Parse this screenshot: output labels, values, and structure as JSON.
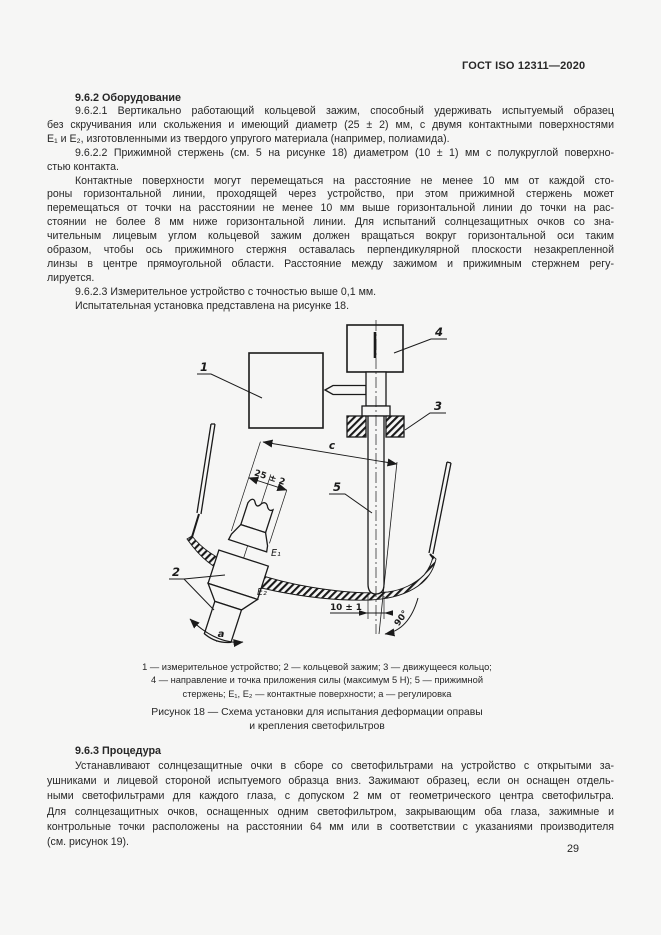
{
  "doc": {
    "header": "ГОСТ ISO 12311—2020",
    "page_number": "29",
    "s962_heading": "9.6.2 Оборудование",
    "p1_lines": [
      "9.6.2.1 Вертикально работающий кольцевой зажим, способный удерживать испытуемый образец",
      "без скручивания или скольжения и имеющий диаметр (25 ± 2) мм, с двумя контактными поверхностями",
      "E₁ и E₂, изготовленными из твердого упругого материала (например, полиамида)."
    ],
    "p2_lines": [
      "9.6.2.2 Прижимной стержень (см. 5 на рисунке 18) диаметром (10 ± 1) мм с полукруглой поверхно-",
      "стью контакта."
    ],
    "p3_lines": [
      "Контактные поверхности могут перемещаться на расстояние не менее 10 мм от каждой сто-",
      "роны горизонтальной линии, проходящей через устройство, при этом прижимной стержень может",
      "перемещаться от точки на расстоянии не менее 10 мм выше горизонтальной линии до точки на рас-",
      "стоянии не более 8 мм ниже горизонтальной линии. Для испытаний солнцезащитных очков со зна-",
      "чительным лицевым углом кольцевой зажим должен вращаться вокруг горизонтальной оси таким",
      "образом, чтобы ось прижимного стержня оставалась перпендикулярной плоскости незакрепленной",
      "линзы в центре прямоугольной области. Расстояние между зажимом и прижимным стержнем регу-",
      "лируется."
    ],
    "p4_lines": [
      "9.6.2.3 Измерительное устройство с точностью выше 0,1 мм."
    ],
    "p5_lines": [
      "Испытательная установка представлена на рисунке 18."
    ],
    "legend_lines": [
      "1 — измерительное устройство; 2 — кольцевой зажим; 3 — движущееся кольцо;",
      "4 — направление и точка приложения силы (максимум 5 Н); 5 — прижимной",
      "стержень; E₁, E₂ — контактные поверхности; a — регулировка"
    ],
    "caption_lines": [
      "Рисунок 18 — Схема установки для испытания деформации оправы",
      "и крепления светофильтров"
    ],
    "s963_heading": "9.6.3 Процедура",
    "p6_lines": [
      "Устанавливают солнцезащитные очки в сборе со светофильтрами на устройство с открытыми за-",
      "ушниками и лицевой стороной испытуемого образца вниз. Зажимают образец, если он оснащен отдель-",
      "ными светофильтрами для каждого глаза, с допуском 2 мм от геометрического центра светофильтра.",
      "Для солнцезащитных очков, оснащенных одним светофильтром, закрывающим оба глаза, зажимные и",
      "контрольные точки расположены на расстоянии 64 мм или в соответствии с указаниями производителя",
      "(см. рисунок 19)."
    ]
  },
  "figure": {
    "labels": {
      "n1": "1",
      "n2": "2",
      "n3": "3",
      "n4": "4",
      "n5": "5",
      "e1": "E₁",
      "e2": "E₂",
      "c": "c",
      "dim25": "25 ± 2",
      "dim10": "10 ± 1",
      "angle": "90°",
      "adjust": "a"
    },
    "line_color": "#1a1a1a"
  }
}
